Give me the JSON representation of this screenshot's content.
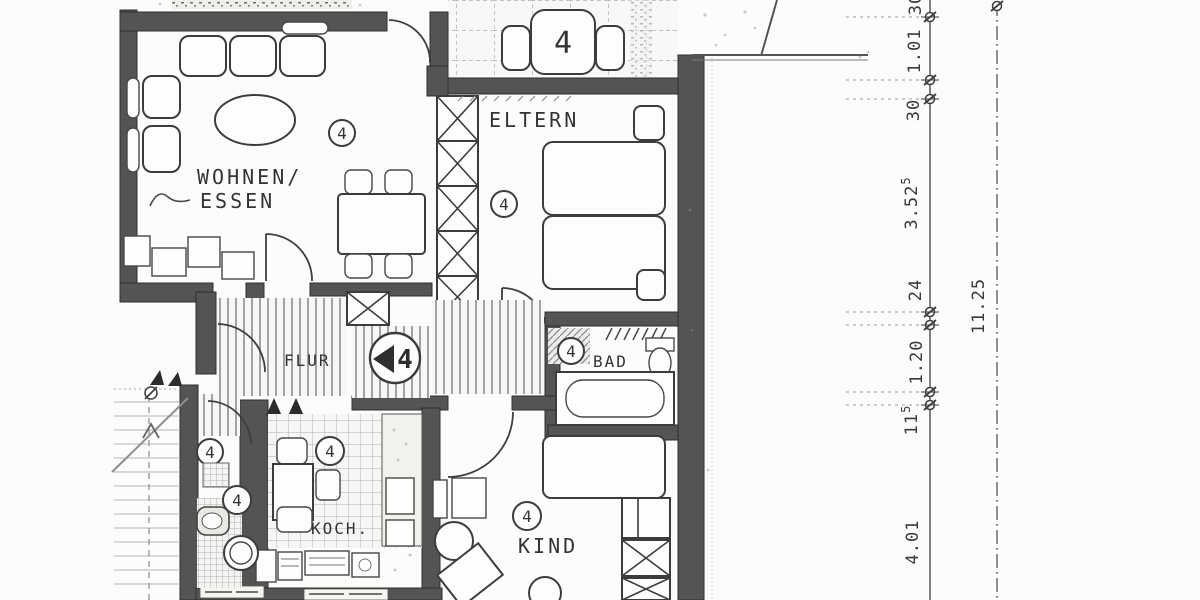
{
  "plan": {
    "unit_number": "4"
  },
  "rooms": {
    "wohnen": {
      "label_line1": "WOHNEN/",
      "label_line2": "ESSEN",
      "marker": "4"
    },
    "eltern": {
      "label": "ELTERN",
      "marker": "4"
    },
    "flur": {
      "label": "FLUR",
      "marker": "4"
    },
    "bad": {
      "label": "BAD",
      "marker": "4"
    },
    "koch": {
      "label": "KOCH.",
      "marker": "4"
    },
    "kind": {
      "label": "KIND",
      "marker": "4"
    },
    "wc": {
      "marker_upper": "4",
      "marker_lower": "4"
    },
    "balkon": {
      "table_marker": "4"
    }
  },
  "dimensions": {
    "chain": [
      {
        "v": "30",
        "sup": ""
      },
      {
        "v": "1.01",
        "sup": ""
      },
      {
        "v": "30",
        "sup": ""
      },
      {
        "v": "3.52",
        "sup": "5"
      },
      {
        "v": "24",
        "sup": ""
      },
      {
        "v": "1.20",
        "sup": ""
      },
      {
        "v": "11",
        "sup": "5"
      },
      {
        "v": "4.01",
        "sup": ""
      }
    ],
    "total": "11.25"
  }
}
